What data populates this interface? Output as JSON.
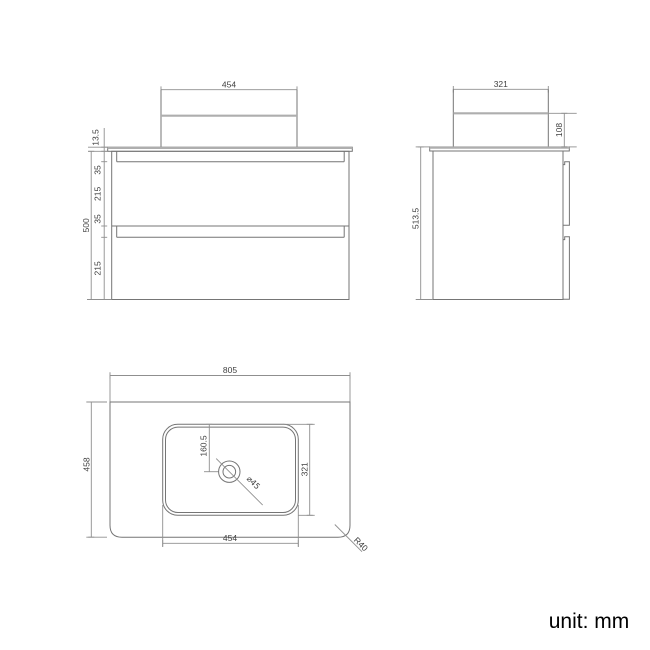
{
  "front_view": {
    "basin_width": "454",
    "worktop_thickness": "13.5",
    "handle_gap_top": "35",
    "drawer_top_height": "215",
    "handle_gap_bottom": "35",
    "drawer_bottom_height": "215",
    "cabinet_height": "500"
  },
  "side_view": {
    "basin_depth": "321",
    "basin_height": "108",
    "overall_height": "513.5"
  },
  "plan_view": {
    "worktop_width": "805",
    "worktop_depth": "458",
    "basin_center_offset": "160.5",
    "basin_depth": "321",
    "basin_width": "454",
    "drain_diameter": "⌀45",
    "corner_radius": "R40"
  },
  "footer": {
    "unit_note": "unit: mm"
  },
  "colors": {
    "object_line": "#757575",
    "accent_gray": "#aeaeae",
    "dimension_line": "#8f8f8f",
    "text": "#3f3f3f",
    "background": "#ffffff"
  }
}
